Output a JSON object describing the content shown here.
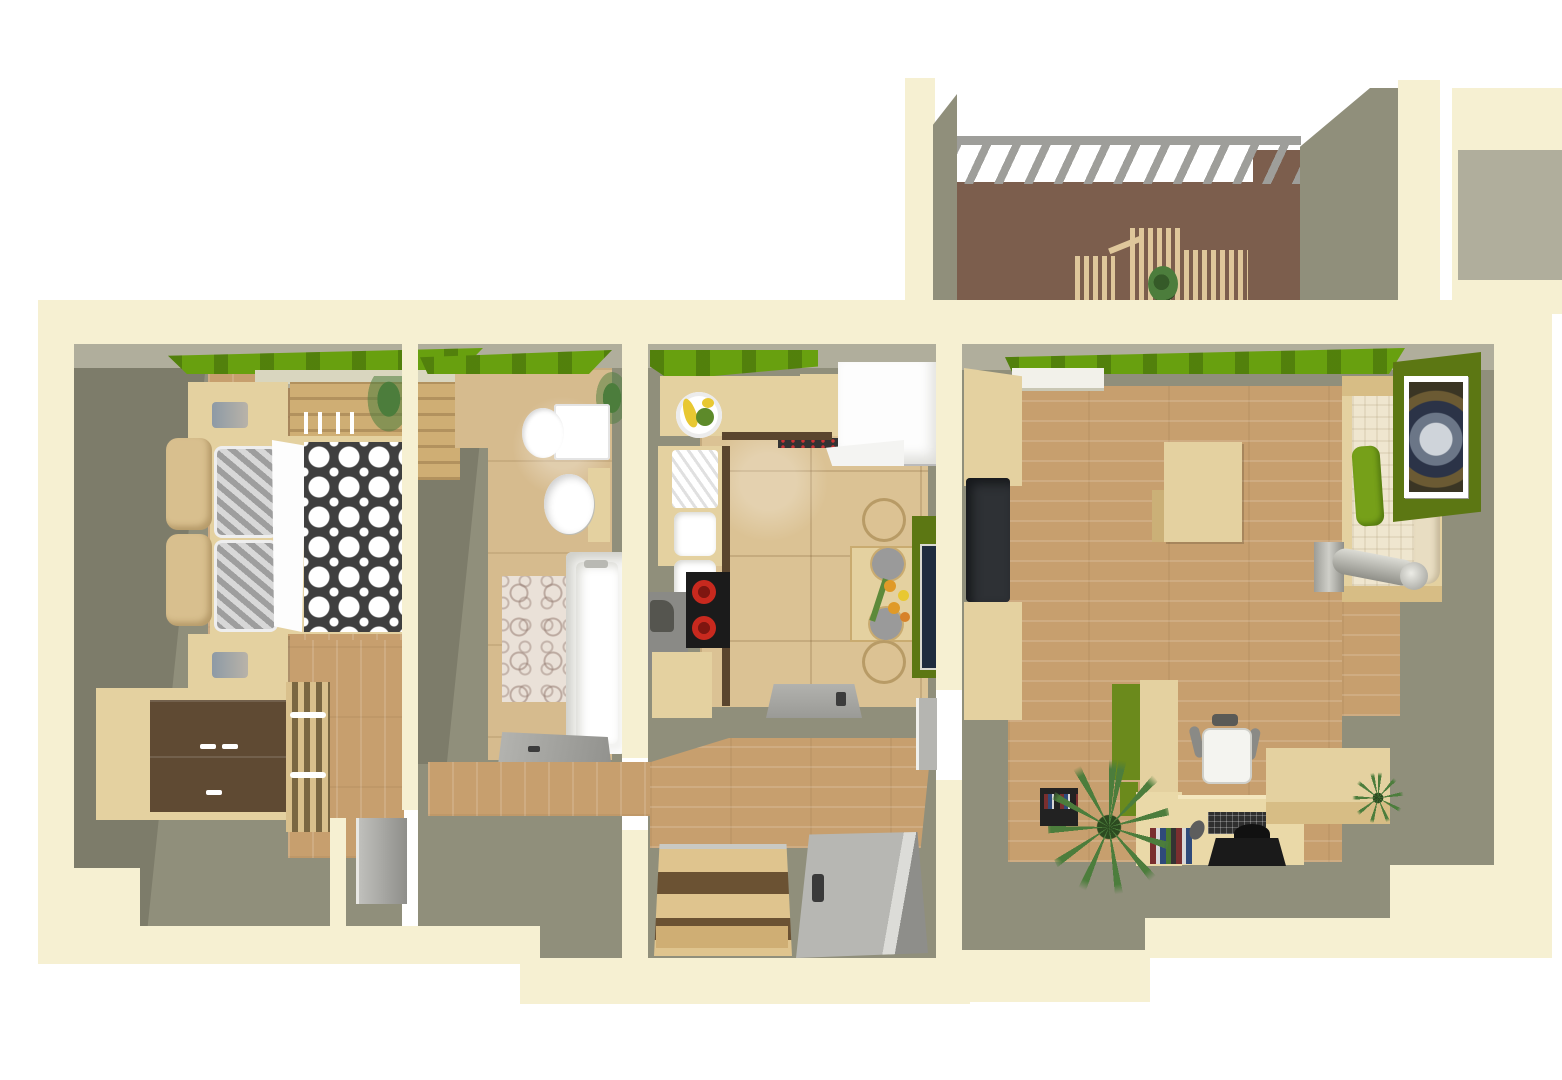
{
  "scene": {
    "kind": "3d-apartment-floorplan-render",
    "view": "top-down-perspective",
    "rooms": [
      {
        "id": "balcony",
        "items": [
          "pergola-beam",
          "pergola-slats",
          "slatted-bench",
          "slatted-table",
          "slatted-chairs",
          "potted-plant"
        ]
      },
      {
        "id": "bedroom",
        "items": [
          "window-greenery",
          "wardrobe-sliding",
          "nightstand-top",
          "nightstand-bottom",
          "table-lamps",
          "double-bed",
          "headboard-cushions",
          "striped-pillows",
          "white-sheet",
          "circle-pattern-duvet",
          "dresser-dark-front",
          "slatted-cabinet",
          "corner-plant"
        ]
      },
      {
        "id": "bathroom",
        "items": [
          "window-greenery",
          "toilet",
          "round-washbasin",
          "bathtub",
          "circle-bath-mat",
          "plant",
          "open-door"
        ]
      },
      {
        "id": "kitchen",
        "items": [
          "window-greenery",
          "fruit-plate",
          "counter",
          "double-sink",
          "cooktop-red-burners",
          "gray-appliance",
          "fridge-freezer",
          "dining-table",
          "stools",
          "flower-bouquet",
          "green-wall-panel",
          "doormat"
        ]
      },
      {
        "id": "living-room",
        "items": [
          "window-greenery",
          "radiator-sill",
          "media-cabinet-top",
          "wall-tv",
          "media-cabinet-bottom",
          "coffee-table",
          "daybed-green-cushion",
          "framed-abstract-art",
          "silver-floor-lamp",
          "green-bookcase",
          "l-desk",
          "monitor",
          "keyboard",
          "mouse",
          "books",
          "office-chair",
          "black-shelf",
          "palm-plant",
          "sideboard",
          "potted-plant"
        ]
      },
      {
        "id": "hallway",
        "items": [
          "wood-corridor",
          "staircase",
          "open-front-door",
          "open-bedroom-door",
          "threshold"
        ]
      }
    ]
  },
  "colors": {
    "page_bg": "#ffffff",
    "outer_wall": "#f6f0d2",
    "inner_wall": "#908f7b",
    "inner_wall_dark": "#7d7c6a",
    "inner_wall_light": "#b0ae9c",
    "wall_top_edge": "#d9d6bf",
    "wood_floor": "#c79f6e",
    "tile_kitchen": "#dbc294",
    "tile_bath": "#d6bb8e",
    "balcony_floor": "#7c5e4d",
    "grass_green": "#68a00f",
    "accent_olive": "#5c7713",
    "green_cushion": "#76a019",
    "furniture_light": "#e4d1a0",
    "furniture_mid": "#cfae74",
    "furniture_dark": "#5f4a33",
    "slat_wood": "#dfc79b",
    "fixture_white": "#ffffff",
    "tv_dark": "#2e3135",
    "stove_black": "#1b1b1b",
    "burner_red": "#c8291e",
    "door_gray": "#a9a9a5",
    "pergola_gray": "#9e9e9a",
    "metal_silver": "#c6c6c0",
    "plant_green": "#4c7d3c",
    "flower_orange": "#e09a28",
    "duvet_dark": "#3f3f3f",
    "pillow_gray": "#9e9e9e",
    "mat_pink": "#eae1d8"
  }
}
